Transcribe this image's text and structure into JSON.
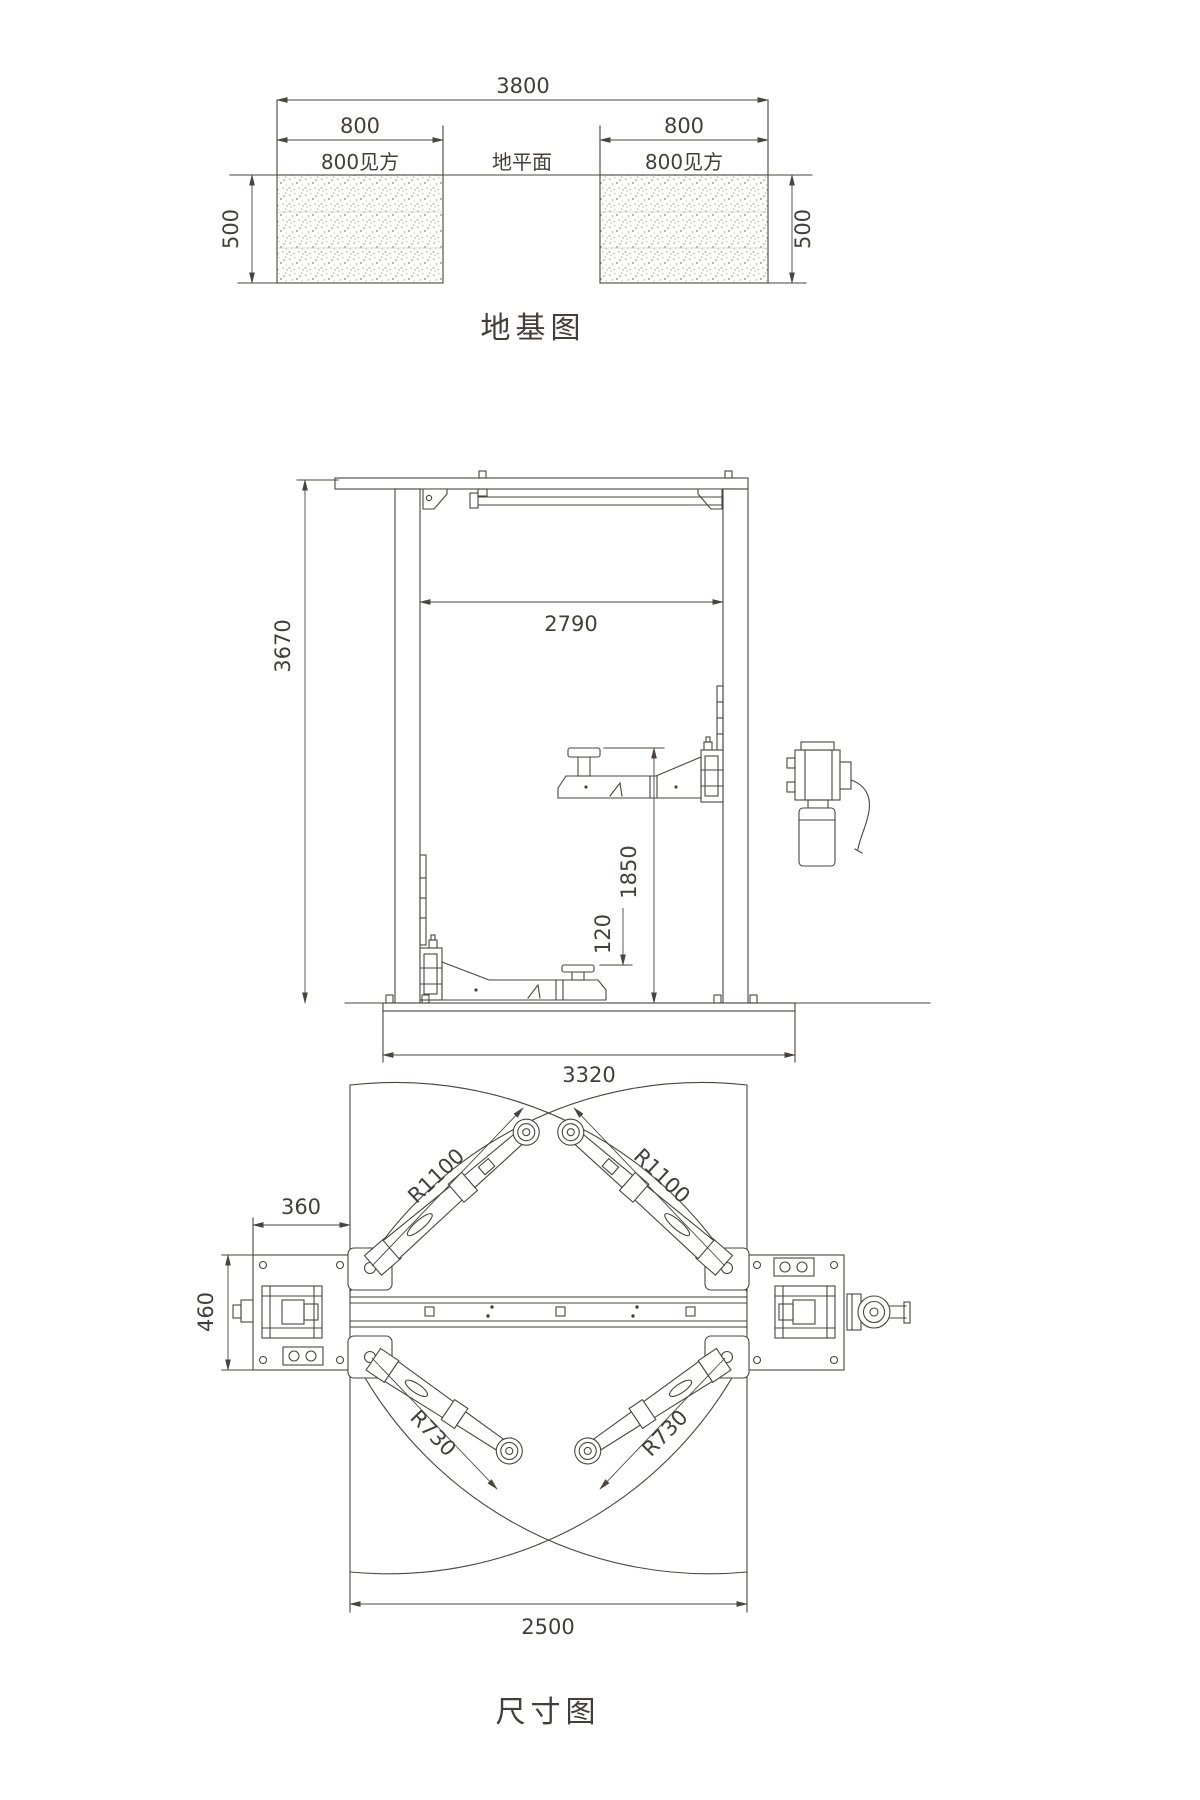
{
  "page": {
    "background": "#ffffff",
    "line_color": "#4a443f",
    "text_color": "#443e3a"
  },
  "foundation_diagram": {
    "title": "地基图",
    "dim_overall_width": "3800",
    "ground_label": "地平面",
    "left_pad": {
      "dim_width": "800",
      "label": "800见方",
      "dim_depth": "500"
    },
    "right_pad": {
      "dim_width": "800",
      "label": "800见方",
      "dim_depth": "500"
    }
  },
  "front_view": {
    "dim_total_height": "3670",
    "dim_clear_width": "2790",
    "dim_max_pad_height": "1850",
    "dim_min_pad_height": "120",
    "dim_base_width": "3320"
  },
  "plan_view": {
    "title": "尺寸图",
    "dim_column_plate_width": "360",
    "dim_column_plate_depth": "460",
    "dim_long_arm_radius_left": "R1100",
    "dim_long_arm_radius_right": "R1100",
    "dim_short_arm_radius_left": "R730",
    "dim_short_arm_radius_right": "R730",
    "dim_drive_through": "2500"
  }
}
